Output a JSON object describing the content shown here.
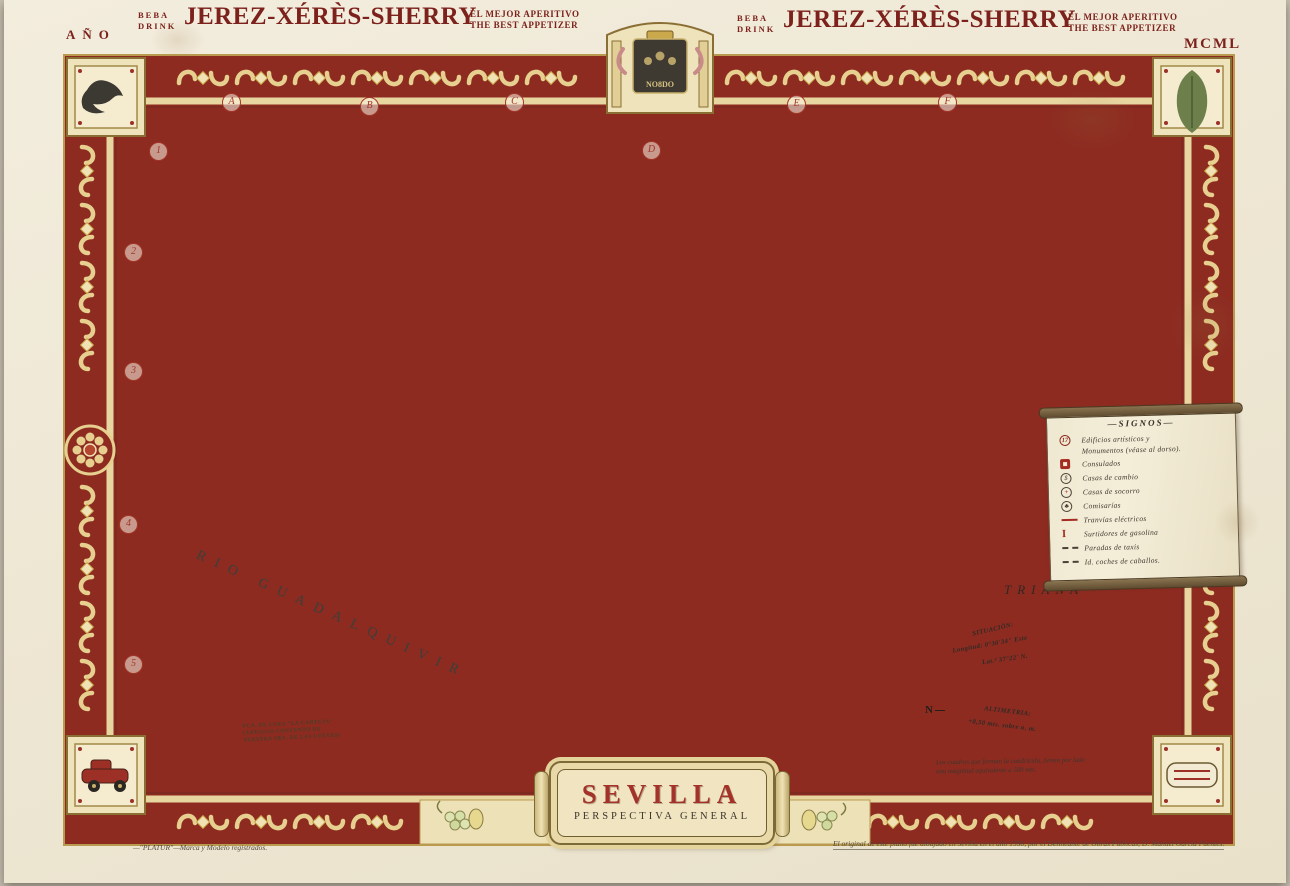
{
  "title_plate": {
    "title": "SEVILLA",
    "subtitle": "PERSPECTIVA GENERAL"
  },
  "header": {
    "ano_label": "AÑO",
    "year_roman": "MCML",
    "left_ad": {
      "line1": "BEBA",
      "line2": "DRINK",
      "title": "JEREZ-XÉRÈS-SHERRY",
      "tagline1": "EL MEJOR APERITIVO",
      "tagline2": "THE BEST APPETIZER"
    },
    "right_ad": {
      "line1": "BEBA",
      "line2": "DRINK",
      "title": "JEREZ-XÉRÈS-SHERRY",
      "tagline1": "EL MEJOR APERITIVO",
      "tagline2": "THE BEST APPETIZER"
    }
  },
  "crest": {
    "motto": "NO8DO"
  },
  "map": {
    "grid_letters": [
      "A",
      "B",
      "C",
      "D",
      "E",
      "F"
    ],
    "grid_numbers": [
      "1",
      "2",
      "3",
      "4",
      "5"
    ],
    "river_label": "RIO GUADALQUIVIR",
    "district_label": "TRIANA",
    "landmark_note": {
      "line1": "FCA. DE LOZA \"LA CARTUJA\"",
      "line2": "(ANTIGUO CONVENTO DE",
      "line3": "NUESTRA SRA. DE LAS CUEVAS)"
    }
  },
  "legend": {
    "title": "—SIGNOS—",
    "items": [
      {
        "icon": "numbered-monument-icon",
        "badge": "17",
        "label": "Edificios artísticos y",
        "label2": "Monumentos (véase al dorso)."
      },
      {
        "icon": "consulate-icon",
        "label": "Consulados"
      },
      {
        "icon": "currency-exchange-icon",
        "badge": "$",
        "label": "Casas de cambio"
      },
      {
        "icon": "first-aid-icon",
        "badge": "+",
        "label": "Casas de socorro"
      },
      {
        "icon": "police-station-icon",
        "badge": "♣",
        "label": "Comisarías"
      },
      {
        "icon": "tram-line-icon",
        "label": "Tranvías eléctricos"
      },
      {
        "icon": "gas-pump-icon",
        "badge": "I",
        "label": "Surtidores de gasolina"
      },
      {
        "icon": "taxi-stand-icon",
        "label": "Paradas de taxis"
      },
      {
        "icon": "horse-carriage-icon",
        "label": "Id. coches de caballos."
      }
    ]
  },
  "compass": {
    "situacion_title": "SITUACIÓN:",
    "longitud": "Longitud: 0°30'34\" Este",
    "latitud": "Lat.ᵈ 37°22' N.",
    "altimetria_title": "ALTIMETRIA:",
    "altimetria_value": "+8,50 mts. sobre n. m.",
    "north_label": "N"
  },
  "notes": {
    "grid_note_line1": "Los cuadros que forman la cuadrícula, tienen por lado",
    "grid_note_line2": "una magnitud equivalente a 500 mts.",
    "trademark": "—\"PLATUR\"—Marca y Modelo registrados.",
    "attribution": "El original de este plano fué dibujado en Sevilla en el año 1950, por el Delineante de Obras Públicas, D. Manuel García Fuentes."
  },
  "colors": {
    "border_red": "#8d2b21",
    "gold": "#e6cf8f",
    "cream": "#f0e9d5",
    "city_yellow": "#e7d893",
    "river_gray": "#a9b6ae",
    "road_red": "#ad4338",
    "text_maroon": "#7c211b"
  }
}
